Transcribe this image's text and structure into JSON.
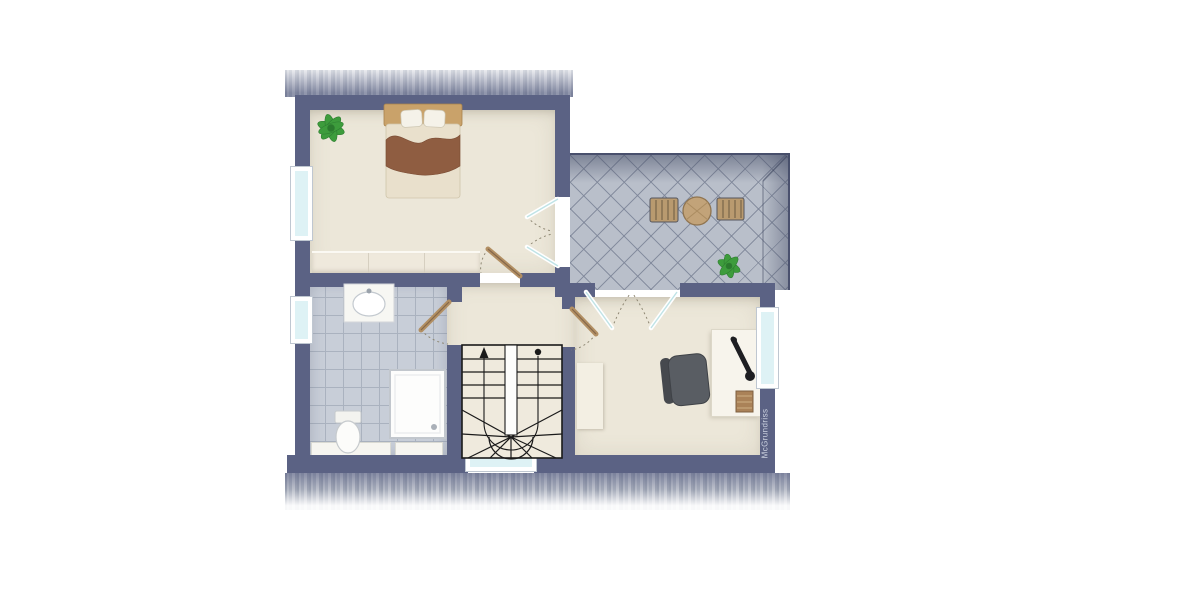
{
  "watermark": {
    "text": "McGrundriss"
  },
  "palette": {
    "wall": "#5b6284",
    "room_floor": "#ece7da",
    "bath_tile": "#c8ced8",
    "terrace_tile": "#b9bfca",
    "window_glass": "#def2f5",
    "door_wood": "#b28f63",
    "plant_green": "#3d9c3c",
    "bed_blanket": "#8f5d41",
    "bed_headboard": "#c9a26a",
    "stair_line": "#1a1a1a",
    "roof_shade": "#7b82a0"
  },
  "rooms": {
    "bedroom": {
      "furniture": [
        "double-bed",
        "built-in-wardrobe",
        "potted-plant"
      ]
    },
    "terrace": {
      "furniture": [
        "round-table",
        "deck-chair-left",
        "deck-chair-right",
        "potted-plant"
      ]
    },
    "bathroom": {
      "furniture": [
        "washbasin",
        "toilet",
        "shower"
      ]
    },
    "hallway": {
      "furniture": [
        "winder-staircase"
      ]
    },
    "office": {
      "furniture": [
        "desk",
        "office-chair",
        "desk-lamp",
        "paper-stack",
        "cabinet"
      ]
    }
  }
}
